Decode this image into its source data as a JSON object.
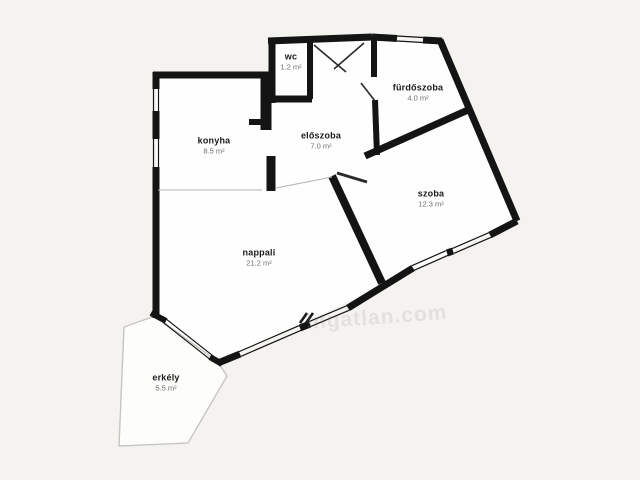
{
  "page": {
    "background_color": "#f4f3f0",
    "room_fill_color": "#fefefe",
    "wall_color": "#141414",
    "balcony_outline_color": "#c8c5bf"
  },
  "watermark": {
    "text": "ingatlan.com",
    "logo": "double-slash"
  },
  "rooms": [
    {
      "id": "wc",
      "name": "wc",
      "area": "1.2 m²"
    },
    {
      "id": "furdoszoba",
      "name": "fürdőszoba",
      "area": "4.0 m²"
    },
    {
      "id": "konyha",
      "name": "konyha",
      "area": "8.5 m²"
    },
    {
      "id": "eloszoba",
      "name": "előszoba",
      "area": "7.0 m²"
    },
    {
      "id": "szoba",
      "name": "szoba",
      "area": "12.3 m²"
    },
    {
      "id": "nappali",
      "name": "nappali",
      "area": "21.2 m²"
    },
    {
      "id": "erkely",
      "name": "erkély",
      "area": "5.5 m²"
    }
  ]
}
